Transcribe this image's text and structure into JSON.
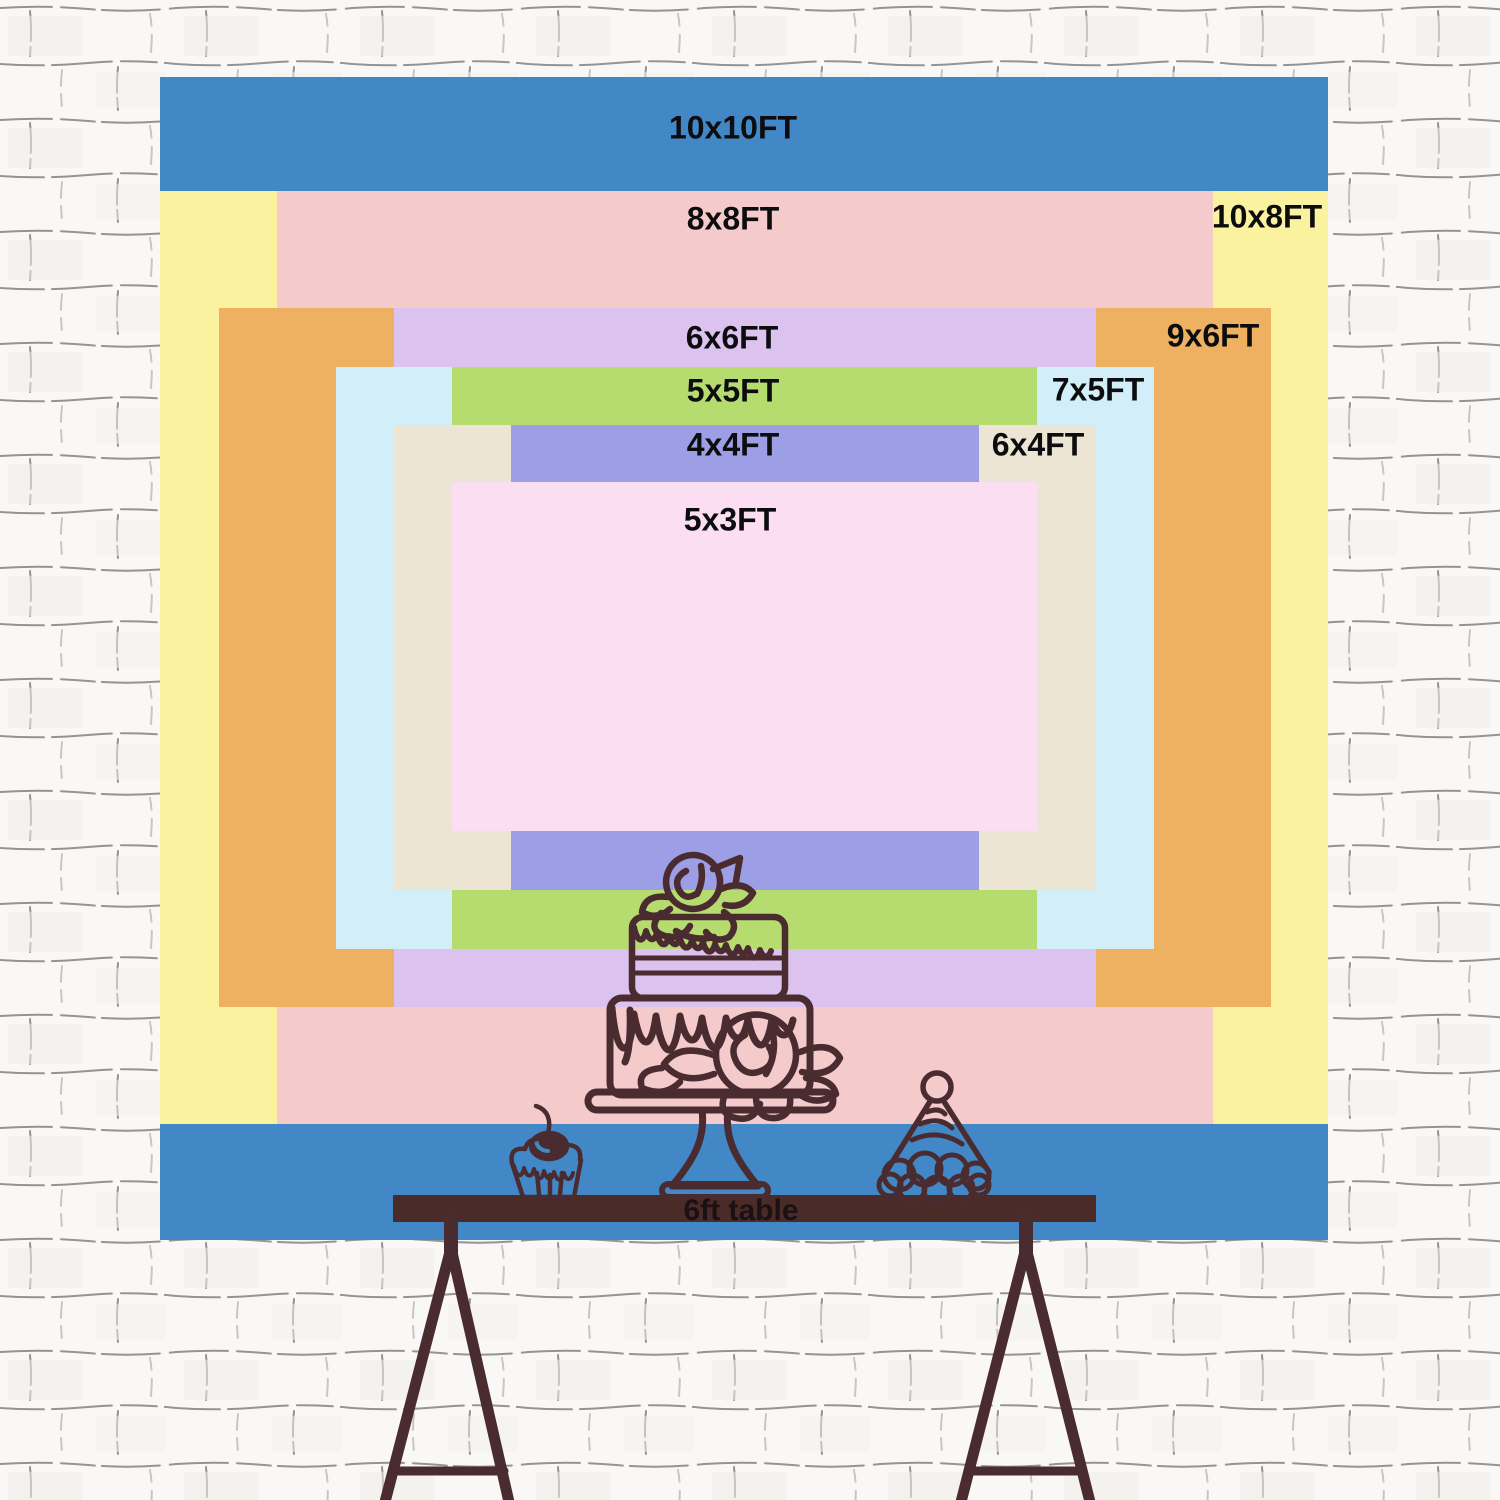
{
  "backdrops": [
    {
      "label": "10x10FT",
      "width_ft": 10,
      "height_ft": 10,
      "color": "#4288c7"
    },
    {
      "label": "10x8FT",
      "width_ft": 10,
      "height_ft": 8,
      "color": "#faf29e"
    },
    {
      "label": "8x8FT",
      "width_ft": 8,
      "height_ft": 8,
      "color": "#f5caca"
    },
    {
      "label": "9x6FT",
      "width_ft": 9,
      "height_ft": 6,
      "color": "#edb161"
    },
    {
      "label": "6x6FT",
      "width_ft": 6,
      "height_ft": 6,
      "color": "#dcc2ee"
    },
    {
      "label": "7x5FT",
      "width_ft": 7,
      "height_ft": 5,
      "color": "#d2eef8"
    },
    {
      "label": "5x5FT",
      "width_ft": 5,
      "height_ft": 5,
      "color": "#b6dc70"
    },
    {
      "label": "6x4FT",
      "width_ft": 6,
      "height_ft": 4,
      "color": "#ece5d3"
    },
    {
      "label": "4x4FT",
      "width_ft": 4,
      "height_ft": 4,
      "color": "#9c9ee6"
    },
    {
      "label": "5x3FT",
      "width_ft": 5,
      "height_ft": 3,
      "color": "#fcdef2"
    }
  ],
  "table": {
    "label": "6ft table"
  },
  "icons": {
    "cake": "two-tier drip cake with roses on a pedestal stand",
    "cupcake": "cupcake with cherry",
    "party_hat": "striped cone party hat with pom-pom",
    "legs": "trestle table legs"
  },
  "colors": {
    "line_art": "#4a2c30",
    "table_bar": "#4a2b28",
    "label_text": "#0d0d10",
    "brick_line": "#75726e",
    "brick_fill": "#f9f8f6"
  }
}
